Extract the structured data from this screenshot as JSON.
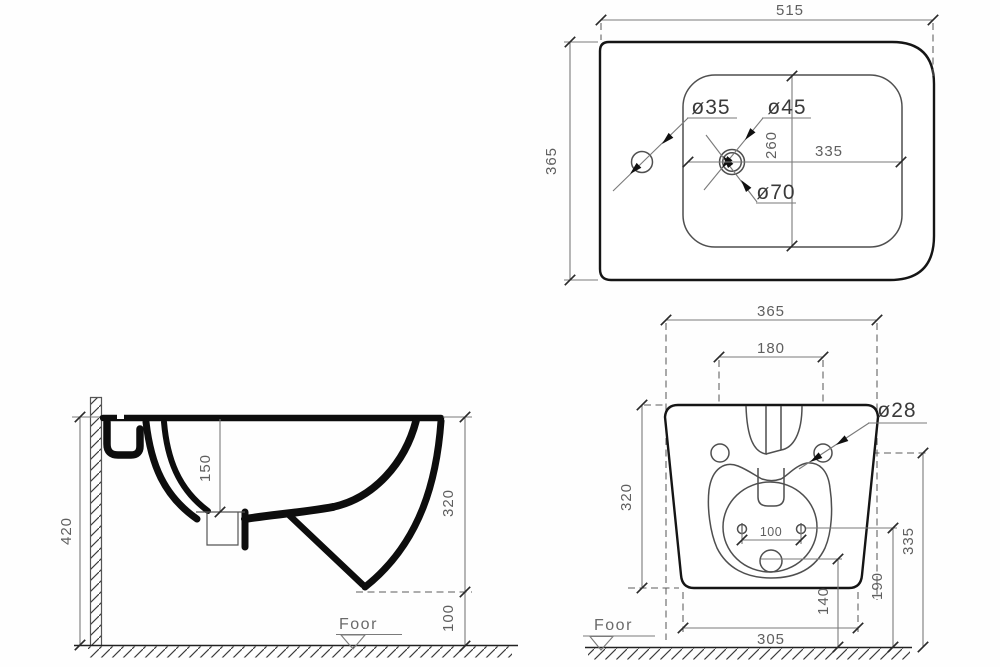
{
  "views": {
    "plan": {
      "d_width": "515",
      "d_depth": "365",
      "d_len": "335",
      "d_cross": "260",
      "h_small": "ø35",
      "h_mid": "ø45",
      "h_big": "ø70"
    },
    "side": {
      "d_total_h": "420",
      "d_bowl": "150",
      "d_body_h": "320",
      "d_gap": "100",
      "floor_label": "Foor"
    },
    "front": {
      "d_width": "365",
      "d_holes": "180",
      "d_body_h": "320",
      "d_mount_h": "335",
      "d_jets_h": "190",
      "d_drain_h": "140",
      "d_jets": "100",
      "d_bottom": "305",
      "h_mount": "ø28",
      "floor_label": "Foor"
    }
  }
}
